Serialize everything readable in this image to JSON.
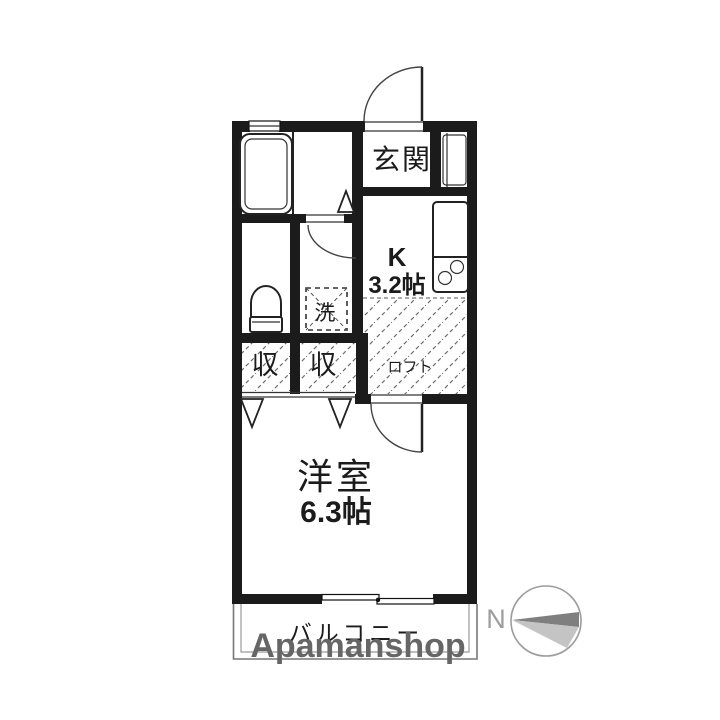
{
  "floorplan": {
    "labels": {
      "entrance": "玄関",
      "kitchen": "K",
      "kitchen_size": "3.2帖",
      "washer": "洗",
      "closet_left": "収",
      "closet_right": "収",
      "loft": "ロフト",
      "western_room": "洋室",
      "western_room_size": "6.3帖",
      "balcony": "バルコニー"
    },
    "compass": {
      "north": "N"
    },
    "watermark": {
      "brand": "Apamanshop"
    },
    "colors": {
      "wall": "#1b1b1b",
      "hatch": "#6f6f6f",
      "balcony_label": "#a8a8a8",
      "watermark": "#666666",
      "compass_outline": "#9c9c9c",
      "north_letter": "#9c9c9c",
      "needle_dark": "#7f7f7f",
      "needle_light": "#c4c4c4"
    }
  }
}
